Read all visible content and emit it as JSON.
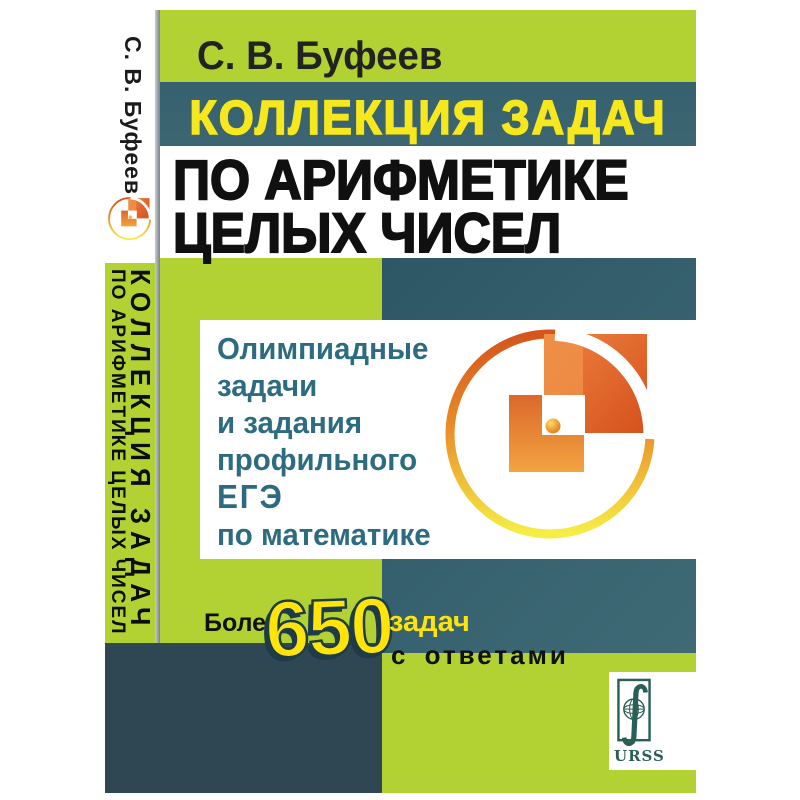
{
  "book": {
    "author": "С. В. Буфеев",
    "title_line1": "КОЛЛЕКЦИЯ ЗАДАЧ",
    "title_line2": "ПО АРИФМЕТИКЕ",
    "title_line3": "ЦЕЛЫХ ЧИСЕЛ",
    "subtitle": {
      "line1": "Олимпиадные",
      "line2": "задачи",
      "line3": "и задания",
      "line4": "профильного",
      "line5": "ЕГЭ",
      "line6": "по математике"
    },
    "badge": {
      "prefix": "Более",
      "count": "650",
      "noun": "задач",
      "suffix": "с ответами"
    },
    "publisher": "URSS",
    "spine": {
      "author": "С. В. Буфеев",
      "title_line1": "КОЛЛЕКЦИЯ ЗАДАЧ",
      "title_line2": "ПО АРИФМЕТИКЕ ЦЕЛЫХ ЧИСЕЛ",
      "publisher": "URSS"
    }
  },
  "colors": {
    "green": "#b2d233",
    "teal_band": "#3a626f",
    "dark_slate": "#2f4753",
    "title_yellow": "#f6e81c",
    "badge_yellow": "#ffe40a",
    "panel_text_blue": "#2d6c80",
    "logo_orange": "#e06526",
    "urss_green": "#2a5f57"
  }
}
